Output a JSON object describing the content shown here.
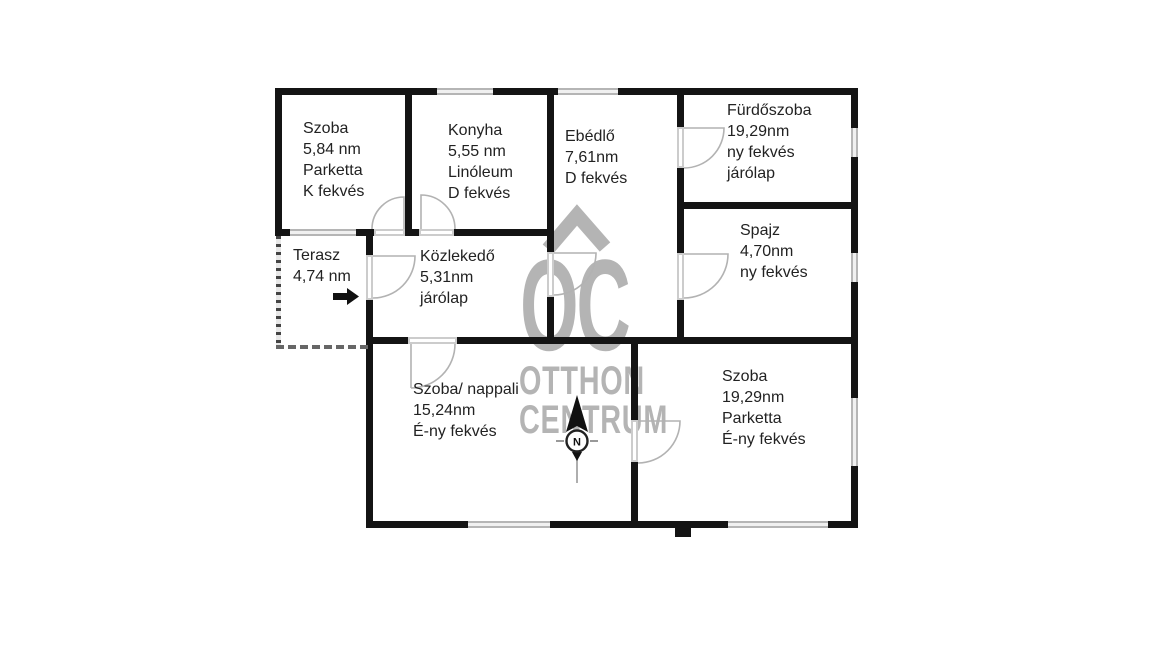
{
  "plan": {
    "rooms": {
      "szoba_1": {
        "label": "Szoba\n5,84 nm\nParketta\nK fekvés"
      },
      "konyha": {
        "label": "Konyha\n5,55 nm\nLinóleum\nD fekvés"
      },
      "ebedlo": {
        "label": "Ebédlő\n7,61nm\nD fekvés"
      },
      "furdoszoba": {
        "label": "Fürdőszoba\n19,29nm\nny fekvés\njárólap"
      },
      "spajz": {
        "label": "Spajz\n4,70nm\nny fekvés"
      },
      "terasz": {
        "label": "Terasz\n4,74 nm"
      },
      "kozlekedo": {
        "label": "Közlekedő\n5,31nm\njárólap"
      },
      "nappali": {
        "label": "Szoba/ nappali\n15,24nm\nÉ-ny fekvés"
      },
      "szoba_2": {
        "label": "Szoba\n19,29nm\nParketta\nÉ-ny fekvés"
      }
    },
    "icons": {
      "entrance_arrow": "right-arrow",
      "compass": "north-arrow"
    }
  },
  "compass": {
    "north_label": "N"
  },
  "watermark": {
    "logo": "OC",
    "name_line1": "OTTHON",
    "name_line2": "CENTRUM"
  },
  "colors": {
    "wall": "#141414",
    "window_gray": "#b5b5b5",
    "door_gray": "#cccccc",
    "watermark_gray": "#b4b4b4",
    "text": "#222222",
    "background": "#ffffff"
  }
}
